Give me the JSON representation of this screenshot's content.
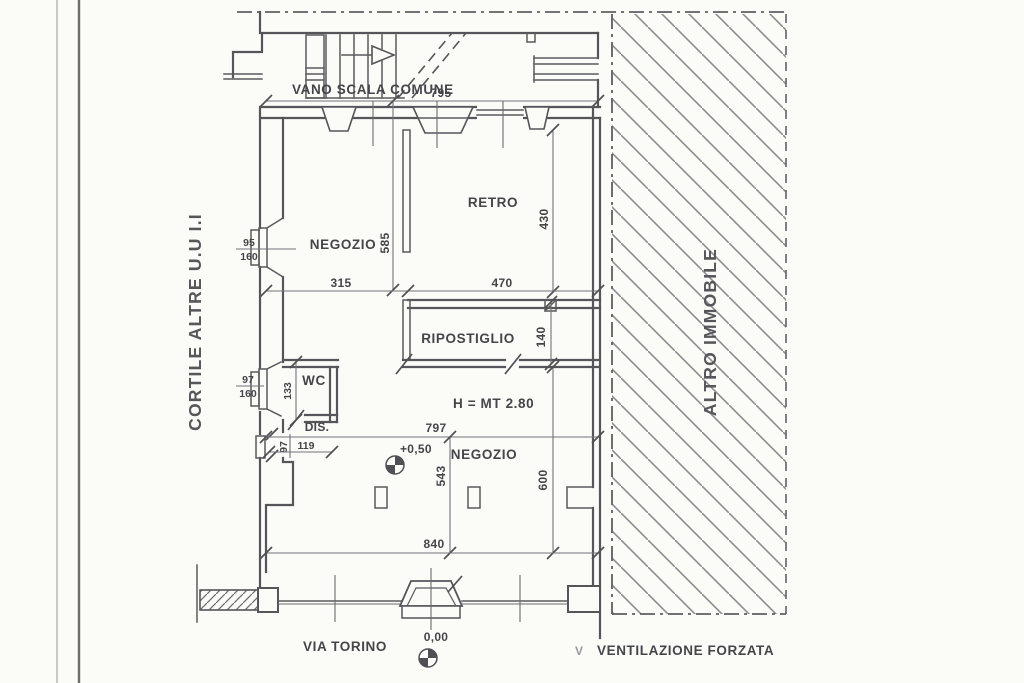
{
  "colors": {
    "paper": "#fbfbf8",
    "wall_line": "#55555a",
    "dimension_line": "#73737a",
    "text": "#45454a",
    "hatch": "#8d8d90"
  },
  "plan": {
    "title_labels": {
      "common_stairwell": "VANO SCALA COMUNE",
      "courtyard": "CORTILE ALTRE U.U I.I",
      "adjacent_building": "ALTRO IMMOBILE",
      "street": "VIA TORINO",
      "forced_ventilation": "VENTILAZIONE FORZATA",
      "ventilation_marker": "V"
    },
    "rooms": {
      "negozio_upper": "NEGOZIO",
      "retro": "RETRO",
      "ripostiglio": "RIPOSTIGLIO",
      "wc": "WC",
      "dis": "DIS.",
      "negozio_lower": "NEGOZIO"
    },
    "annotations": {
      "ceiling_height": "H = MT 2.80",
      "level_entrance": "+0,50",
      "level_street": "0,00"
    },
    "dimensions": {
      "top_width": "795",
      "negozio_height": "585",
      "retro_height": "430",
      "split_left": "315",
      "split_right": "470",
      "ripostiglio_height": "140",
      "middle_width": "797",
      "wc_height": "133",
      "dis_height": "97",
      "dis_width": "119",
      "lower_height": "543",
      "right_lower_height": "600",
      "bottom_width": "840",
      "window_negozio": {
        "w": "95",
        "h": "160"
      },
      "window_wc": {
        "w": "97",
        "h": "160"
      }
    }
  }
}
